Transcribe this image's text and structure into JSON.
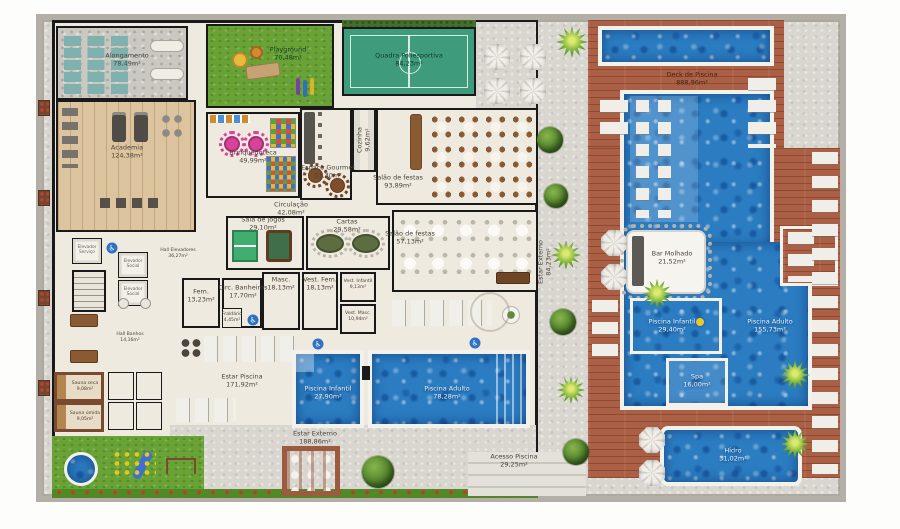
{
  "plan": {
    "title": "Pavimento de lazer - planta humanizada",
    "icons": {
      "accessibility": "♿"
    },
    "colors": {
      "water": "#2b7cc1",
      "deck_wood": "#ab5f44",
      "grass": "#69a336",
      "court_green": "#3e9c7c",
      "wall": "#191919",
      "floor_cream": "#efeadf",
      "wood_floor": "#dcc49e",
      "pavement": "#d9d6d0",
      "accessibility_blue": "#2d72c4"
    },
    "rooms": {
      "alongamento": {
        "name": "Alongamento",
        "area": "78,49m²"
      },
      "academia": {
        "name": "Academia",
        "area": "124,38m²"
      },
      "playground": {
        "name": "Playground",
        "area": "70,48m²"
      },
      "quadra": {
        "name": "Quadra Poliesportiva",
        "area": "84,23m²"
      },
      "brinquedoteca": {
        "name": "Brinquedoteca",
        "area": "49,99m²"
      },
      "espaco_gourmet": {
        "name": "Espaço Gourmet",
        "area": "51,30m²"
      },
      "cozinha": {
        "name": "Cozinha",
        "area": "9,62m²"
      },
      "salao_festas_1": {
        "name": "Salão de festas",
        "area": "93,89m²"
      },
      "circulacao": {
        "name": "Circulação",
        "area": "42,08m²"
      },
      "sala_jogos": {
        "name": "Sala de jogos",
        "area": "29,10m²"
      },
      "cartas": {
        "name": "Cartas",
        "area": "29,58m²"
      },
      "salao_festas_2": {
        "name": "Salão de festas",
        "area": "57,13m²"
      },
      "hall_elevadores": {
        "name": "Hall Elevadores",
        "area": "36,27m²"
      },
      "elevador_servico": {
        "name": "Elevador Serviço",
        "area": ""
      },
      "elevador_social_1": {
        "name": "Elevador Social",
        "area": ""
      },
      "elevador_social_2": {
        "name": "Elevador Social",
        "area": ""
      },
      "fem": {
        "name": "Fem.",
        "area": "13,23m²"
      },
      "circ_banheiros": {
        "name": "Circ. Banheiros",
        "area": "17,70m²"
      },
      "masc": {
        "name": "Masc.",
        "area": "18,13m²"
      },
      "vest_fem": {
        "name": "Vest. Fem.",
        "area": "18,13m²"
      },
      "vest_infantil": {
        "name": "Vest. Infantil",
        "area": "9,13m²"
      },
      "vest_masc": {
        "name": "Vest. Masc.",
        "area": "10,94m²"
      },
      "fraldario": {
        "name": "Fraldário",
        "area": "4,45m²"
      },
      "hall_banhos": {
        "name": "Hall Banhos",
        "area": "14,16m²"
      },
      "sauna_seca": {
        "name": "Sauna seca",
        "area": "9,08m²"
      },
      "sauna_umida": {
        "name": "Sauna úmida",
        "area": "9,05m²"
      },
      "estar_piscina": {
        "name": "Estar Piscina",
        "area": "171,92m²"
      },
      "piscina_infantil_interna": {
        "name": "Piscina Infantil",
        "area": "27,90m²"
      },
      "piscina_adulto_interna": {
        "name": "Piscina Adulto",
        "area": "78,28m²"
      },
      "estar_externo": {
        "name": "Estar Externo",
        "area": "188,86m²"
      },
      "estar_externo_lateral": {
        "name": "Estar Externo",
        "area": "84,23m²"
      },
      "acesso_piscina": {
        "name": "Acesso Piscina",
        "area": "29,25m²"
      },
      "deck_piscina": {
        "name": "Deck de Piscina",
        "area": "888,96m²"
      },
      "bar_molhado": {
        "name": "Bar Molhado",
        "area": "21,52m²"
      },
      "piscina_infantil_externa": {
        "name": "Piscina Infantil",
        "area": "29,40m²"
      },
      "piscina_adulto_externa": {
        "name": "Piscina Adulto",
        "area": "155,73m²"
      },
      "spa": {
        "name": "Spa",
        "area": "16,00m²"
      },
      "hidro": {
        "name": "Hidro",
        "area": "31,02m²"
      }
    }
  }
}
